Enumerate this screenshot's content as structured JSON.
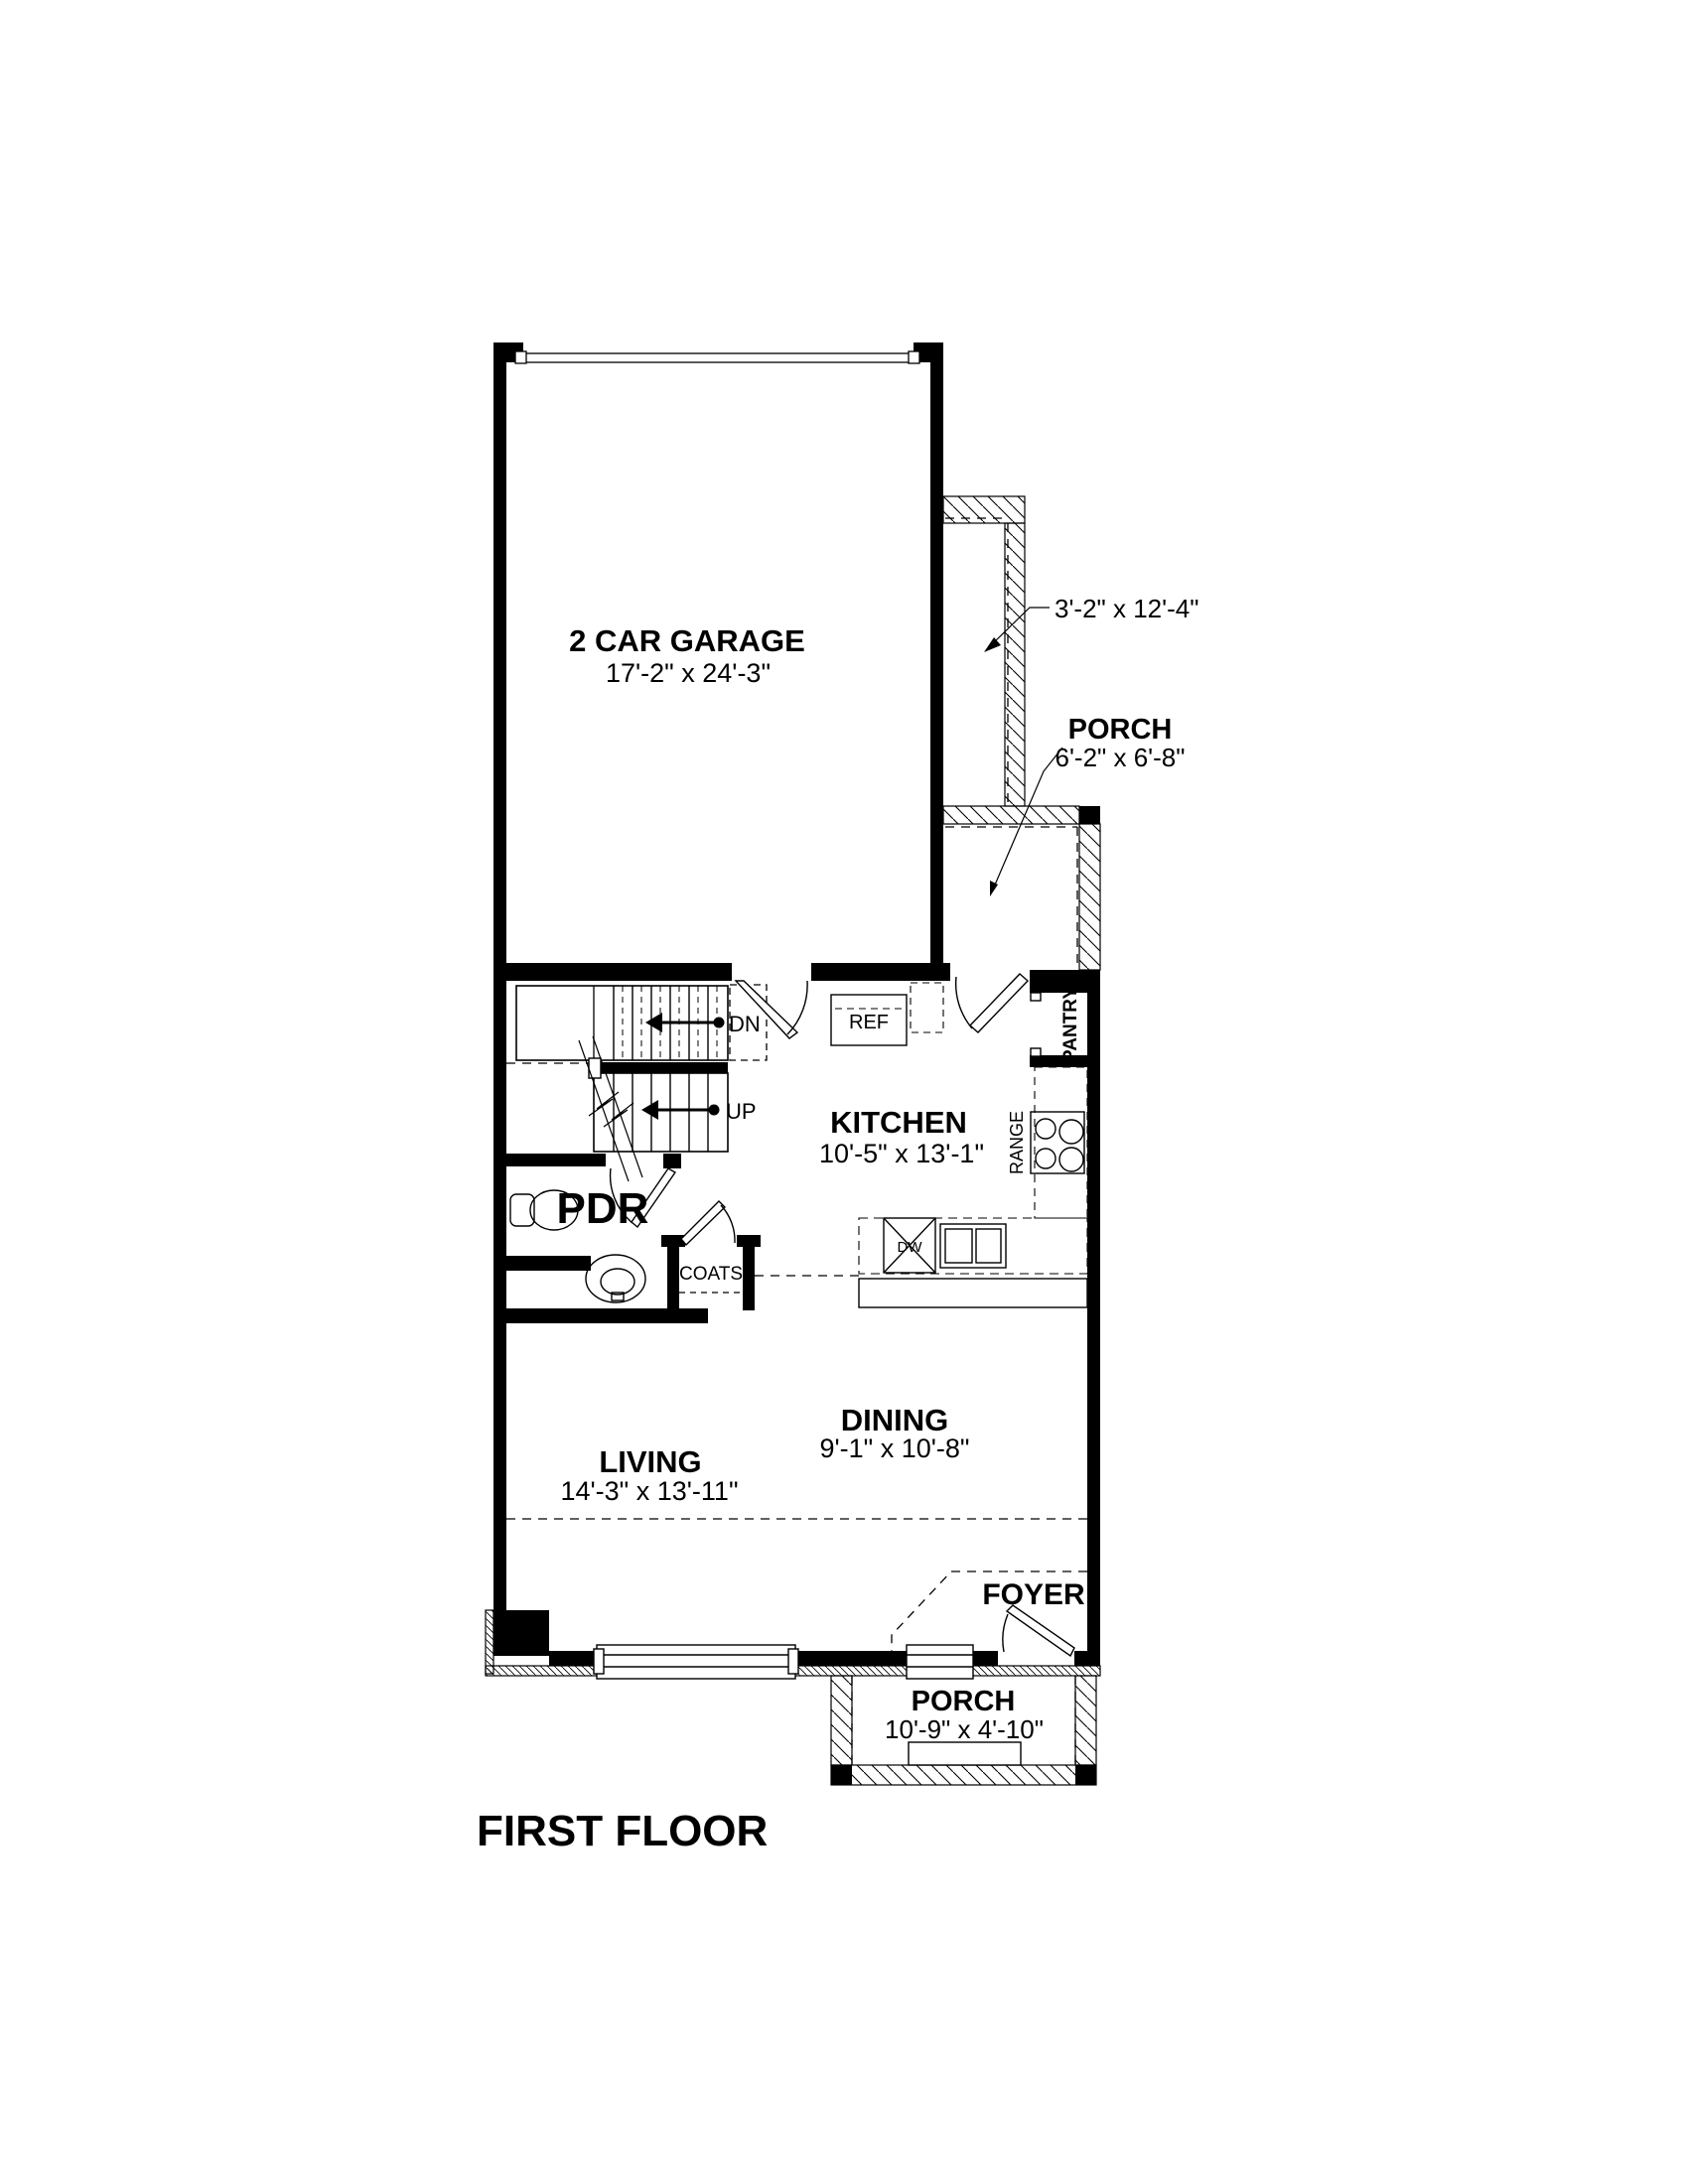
{
  "title": "FIRST FLOOR",
  "rooms": {
    "garage": {
      "name": "2 CAR GARAGE",
      "dims": "17'-2\" x 24'-3\""
    },
    "kitchen": {
      "name": "KITCHEN",
      "dims": "10'-5\" x 13'-1\""
    },
    "living": {
      "name": "LIVING",
      "dims": "14'-3\" x 13'-11\""
    },
    "dining": {
      "name": "DINING",
      "dims": "9'-1\" x 10'-8\""
    },
    "foyer": {
      "name": "FOYER"
    },
    "pdr": {
      "name": "PDR"
    },
    "coats": {
      "name": "COATS"
    },
    "pantry": {
      "name": "PANTRY"
    },
    "porch_side": {
      "name": "PORCH",
      "dims": "6'-2\" x 6'-8\""
    },
    "porch_front": {
      "name": "PORCH",
      "dims": "10'-9\" x 4'-10\""
    },
    "walkway": {
      "dims": "3'-2\" x 12'-4\""
    }
  },
  "fixtures": {
    "refrigerator": "REF",
    "range": "RANGE",
    "dishwasher": "DW"
  },
  "stairs": {
    "down": "DN",
    "up": "UP"
  },
  "colors": {
    "ink": "#000000",
    "background": "#ffffff"
  }
}
